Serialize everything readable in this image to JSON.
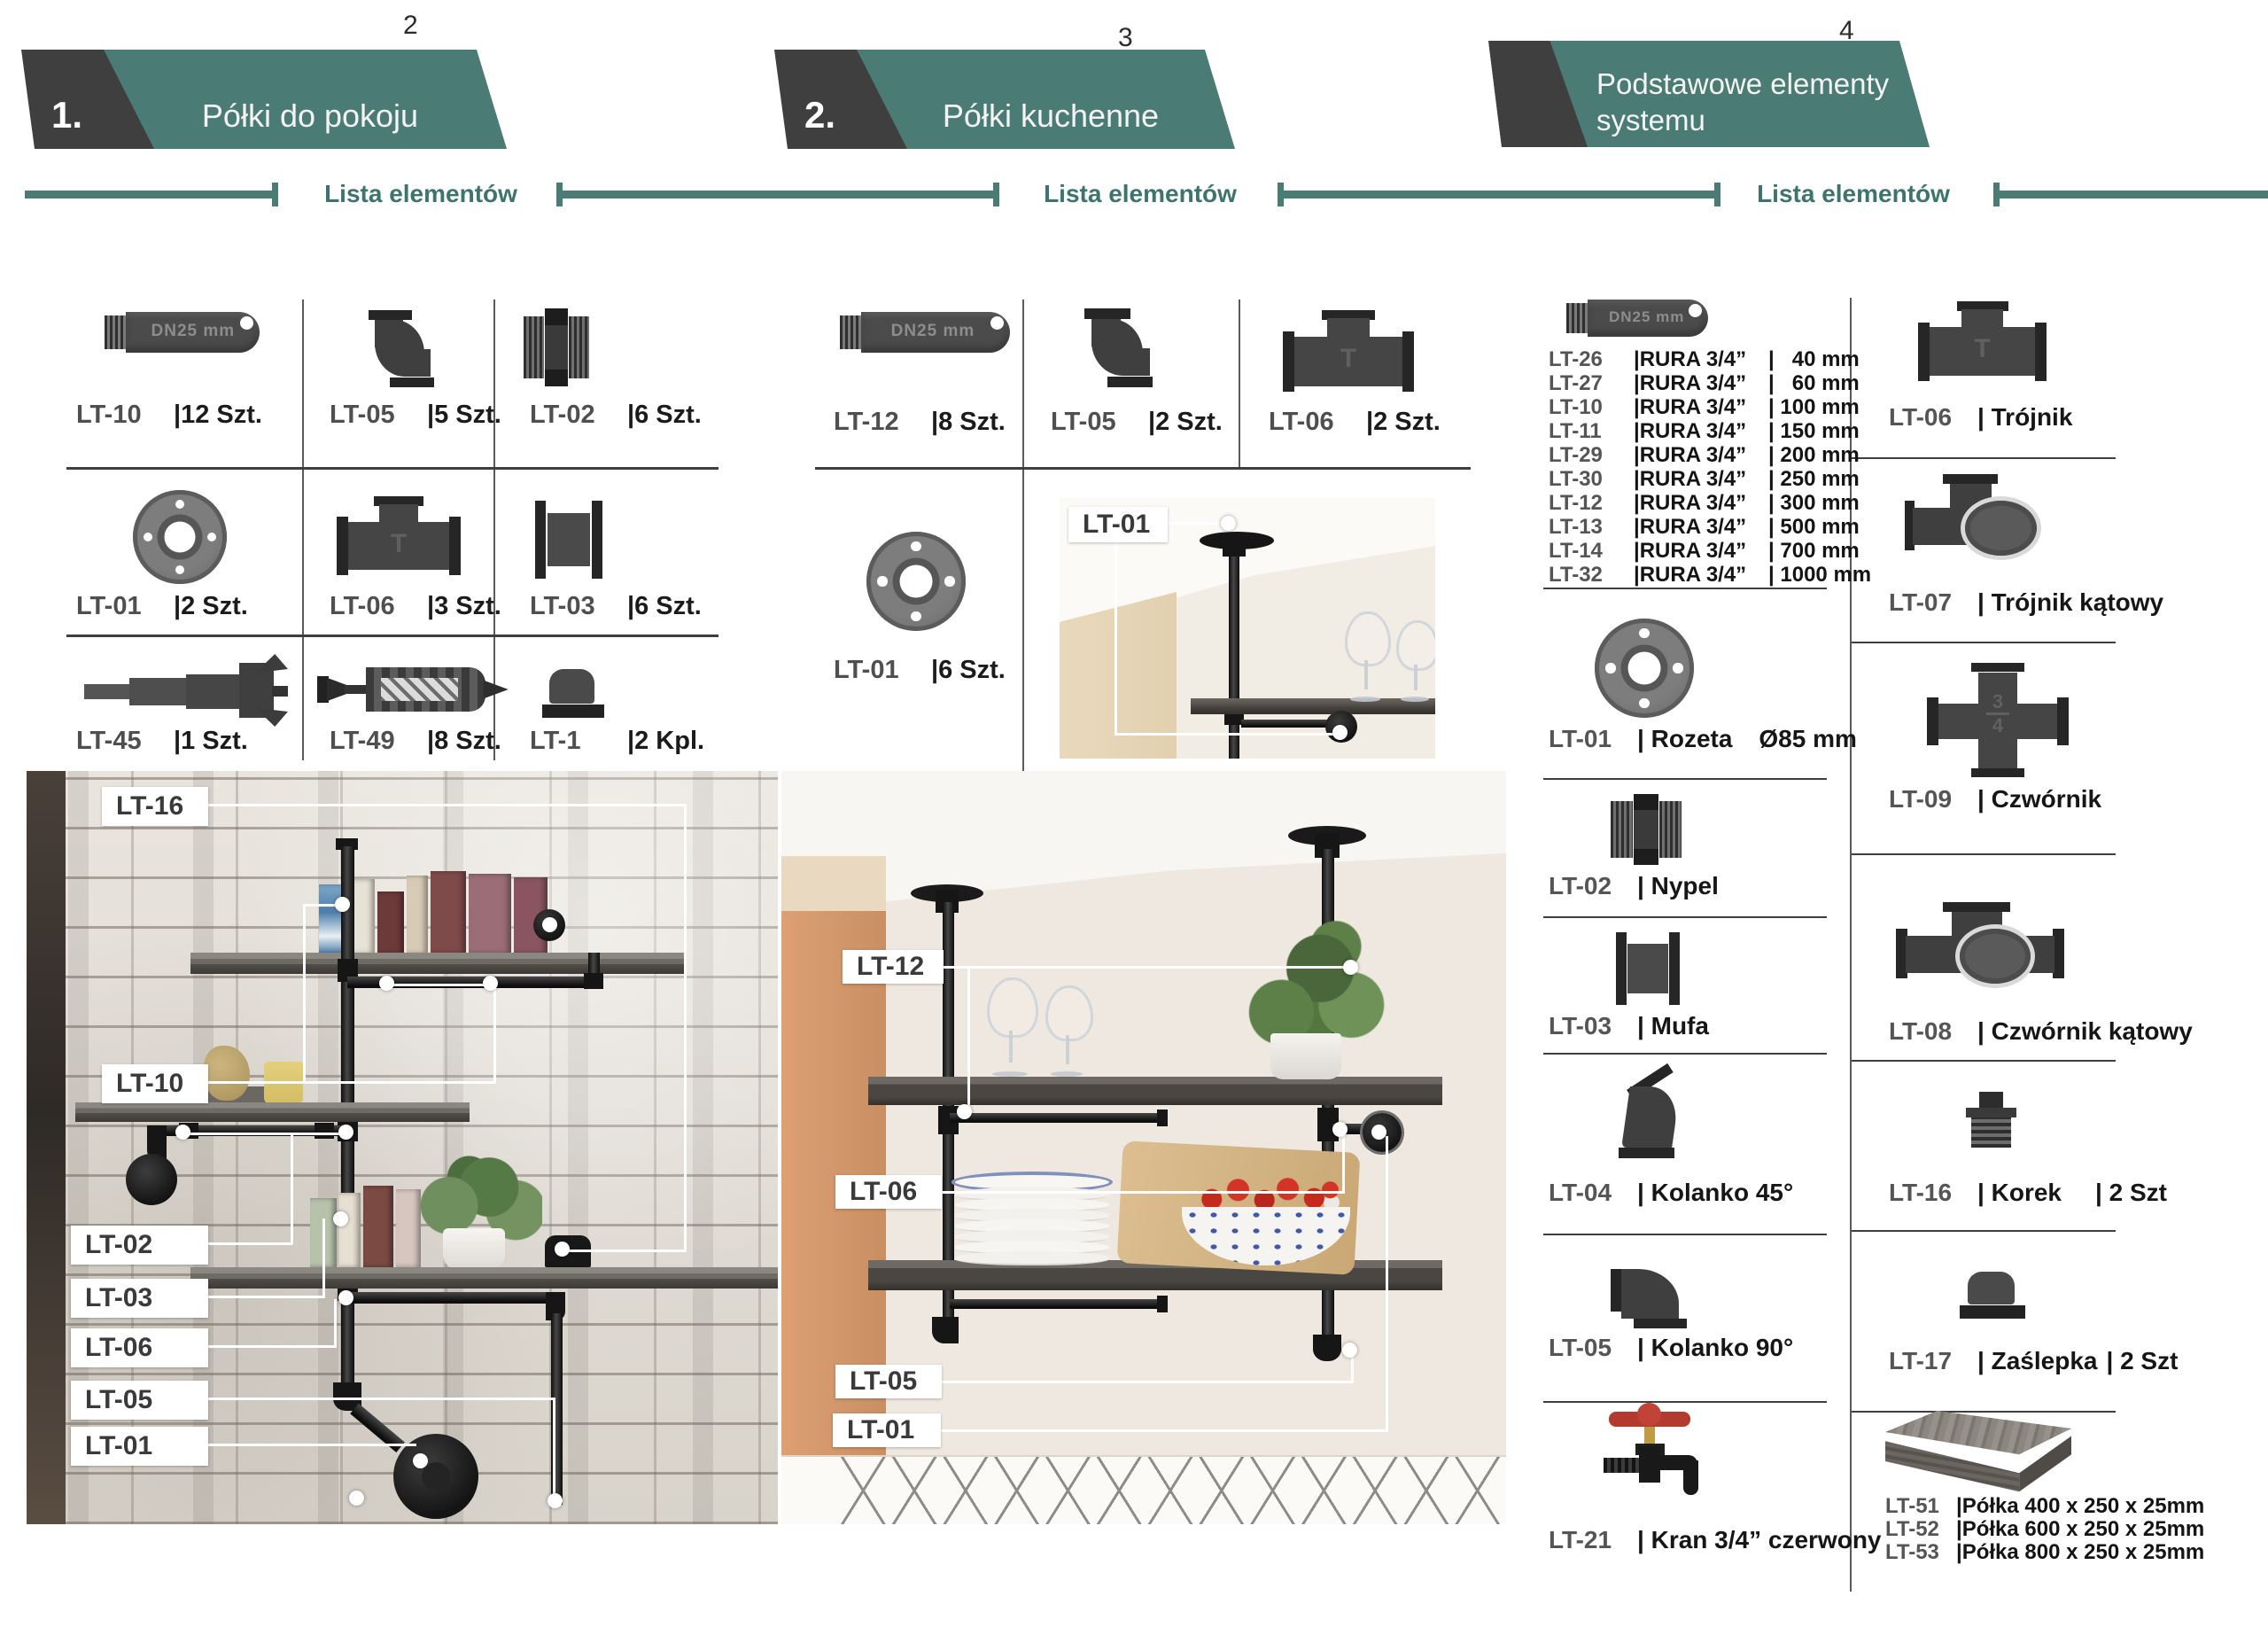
{
  "page_numbers": {
    "p1": "2",
    "p2": "3",
    "p3": "4"
  },
  "tabs": {
    "tab1": {
      "number": "1.",
      "title": "Półki do pokoju"
    },
    "tab2": {
      "number": "2.",
      "title": "Półki kuchenne"
    },
    "tab3": {
      "title_line1": "Podstawowe elementy",
      "title_line2": "systemu"
    }
  },
  "list_header": {
    "label1": "Lista elementów",
    "label2": "Lista elementów",
    "label3": "Lista elementów"
  },
  "badges": {
    "pipe_badge": "DN25 mm",
    "tee_letter": "T",
    "fraction_top": "3",
    "fraction_bottom": "4"
  },
  "section1": {
    "items": [
      {
        "code": "LT-10",
        "qty": "|12 Szt."
      },
      {
        "code": "LT-05",
        "qty": "|5 Szt."
      },
      {
        "code": "LT-02",
        "qty": "|6 Szt."
      },
      {
        "code": "LT-01",
        "qty": "|2 Szt."
      },
      {
        "code": "LT-06",
        "qty": "|3 Szt."
      },
      {
        "code": "LT-03",
        "qty": "|6 Szt."
      },
      {
        "code": "LT-45",
        "qty": "|1 Szt."
      },
      {
        "code": "LT-49",
        "qty": "|8 Szt."
      },
      {
        "code": "LT-1",
        "qty": "|2 Kpl."
      }
    ]
  },
  "section2": {
    "items": [
      {
        "code": "LT-12",
        "qty": "|8 Szt."
      },
      {
        "code": "LT-05",
        "qty": "|2 Szt."
      },
      {
        "code": "LT-06",
        "qty": "|2 Szt."
      },
      {
        "code": "LT-01",
        "qty": "|6 Szt."
      }
    ],
    "inset_label": "LT-01"
  },
  "section3": {
    "rura_items": [
      {
        "code": "LT-26",
        "name": "|RURA 3/4”",
        "size": "|   40 mm"
      },
      {
        "code": "LT-27",
        "name": "|RURA 3/4”",
        "size": "|   60 mm"
      },
      {
        "code": "LT-10",
        "name": "|RURA 3/4”",
        "size": "| 100 mm"
      },
      {
        "code": "LT-11",
        "name": "|RURA 3/4”",
        "size": "| 150 mm"
      },
      {
        "code": "LT-29",
        "name": "|RURA 3/4”",
        "size": "| 200 mm"
      },
      {
        "code": "LT-30",
        "name": "|RURA 3/4”",
        "size": "| 250 mm"
      },
      {
        "code": "LT-12",
        "name": "|RURA 3/4”",
        "size": "| 300 mm"
      },
      {
        "code": "LT-13",
        "name": "|RURA 3/4”",
        "size": "| 500 mm"
      },
      {
        "code": "LT-14",
        "name": "|RURA 3/4”",
        "size": "| 700 mm"
      },
      {
        "code": "LT-32",
        "name": "|RURA 3/4”",
        "size": "| 1000 mm"
      }
    ],
    "left_items": [
      {
        "code": "LT-01",
        "name": "| Rozeta",
        "extra": "Ø85 mm"
      },
      {
        "code": "LT-02",
        "name": "| Nypel",
        "extra": ""
      },
      {
        "code": "LT-03",
        "name": "| Mufa",
        "extra": ""
      },
      {
        "code": "LT-04",
        "name": "| Kolanko 45°",
        "extra": ""
      },
      {
        "code": "LT-05",
        "name": "| Kolanko 90°",
        "extra": ""
      },
      {
        "code": "LT-21",
        "name": "| Kran 3/4” czerwony",
        "extra": ""
      }
    ],
    "right_items": [
      {
        "code": "LT-06",
        "name": "| Trójnik",
        "qty": ""
      },
      {
        "code": "LT-07",
        "name": "| Trójnik kątowy",
        "qty": ""
      },
      {
        "code": "LT-09",
        "name": "| Czwórnik",
        "qty": ""
      },
      {
        "code": "LT-08",
        "name": "| Czwórnik kątowy",
        "qty": ""
      },
      {
        "code": "LT-16",
        "name": "| Korek",
        "qty": "| 2 Szt"
      },
      {
        "code": "LT-17",
        "name": "| Zaślepka",
        "qty": "| 2 Szt"
      }
    ],
    "shelf_items": [
      {
        "code": "LT-51",
        "name": "|Półka 400 x 250 x 25mm"
      },
      {
        "code": "LT-52",
        "name": "|Półka 600 x 250 x 25mm"
      },
      {
        "code": "LT-53",
        "name": "|Półka 800 x 250 x 25mm"
      }
    ]
  },
  "photo1_labels": {
    "l1": "LT-16",
    "l2": "LT-10",
    "l3": "LT-02",
    "l4": "LT-03",
    "l5": "LT-06",
    "l6": "LT-05",
    "l7": "LT-01"
  },
  "photo2_labels": {
    "l1": "LT-12",
    "l2": "LT-06",
    "l3": "LT-05",
    "l4": "LT-01"
  },
  "inset": {
    "label": "LT-01"
  },
  "colors": {
    "teal": "#4a7b75",
    "dark": "#3f3f3f",
    "tap_red": "#b33a2e"
  }
}
